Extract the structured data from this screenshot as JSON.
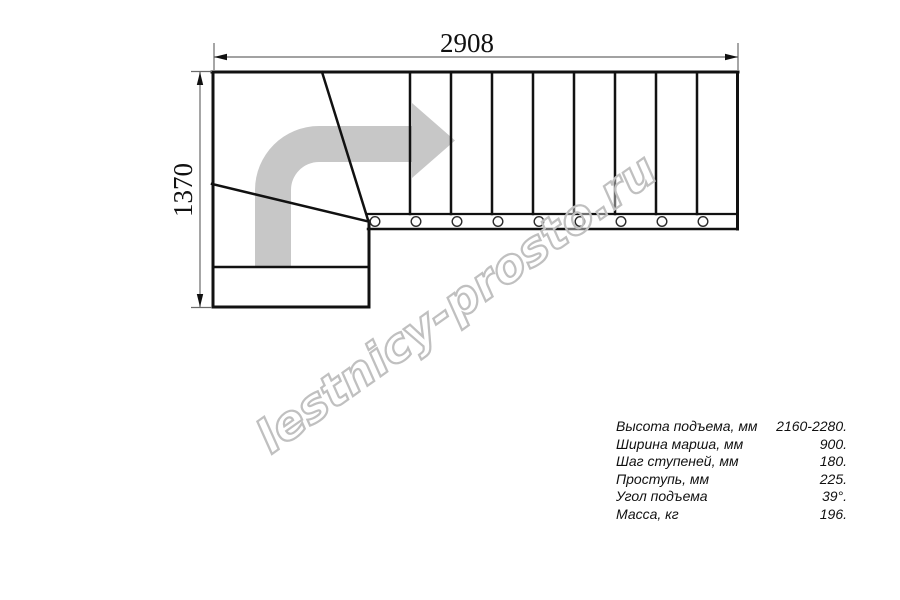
{
  "drawing": {
    "type": "staircase-floor-plan",
    "dimensions": {
      "width_label": "2908",
      "height_label": "1370"
    },
    "tread_count_straight": 9,
    "colors": {
      "line": "#111111",
      "dimension_line": "#6a6a6a",
      "arrow_fill": "#c7c7c7",
      "watermark_outline": "#c0c0c0",
      "background": "#ffffff"
    }
  },
  "watermark": {
    "text": "lestnicy-prosto.ru"
  },
  "specs": {
    "rows": [
      {
        "label": "Высота подъема, мм",
        "value": "2160-2280."
      },
      {
        "label": "Ширина марша, мм",
        "value": "900."
      },
      {
        "label": "Шаг ступеней, мм",
        "value": "180."
      },
      {
        "label": "Проступь, мм",
        "value": "225."
      },
      {
        "label": "Угол подъема",
        "value": "39°."
      },
      {
        "label": "Масса, кг",
        "value": "196."
      }
    ]
  }
}
